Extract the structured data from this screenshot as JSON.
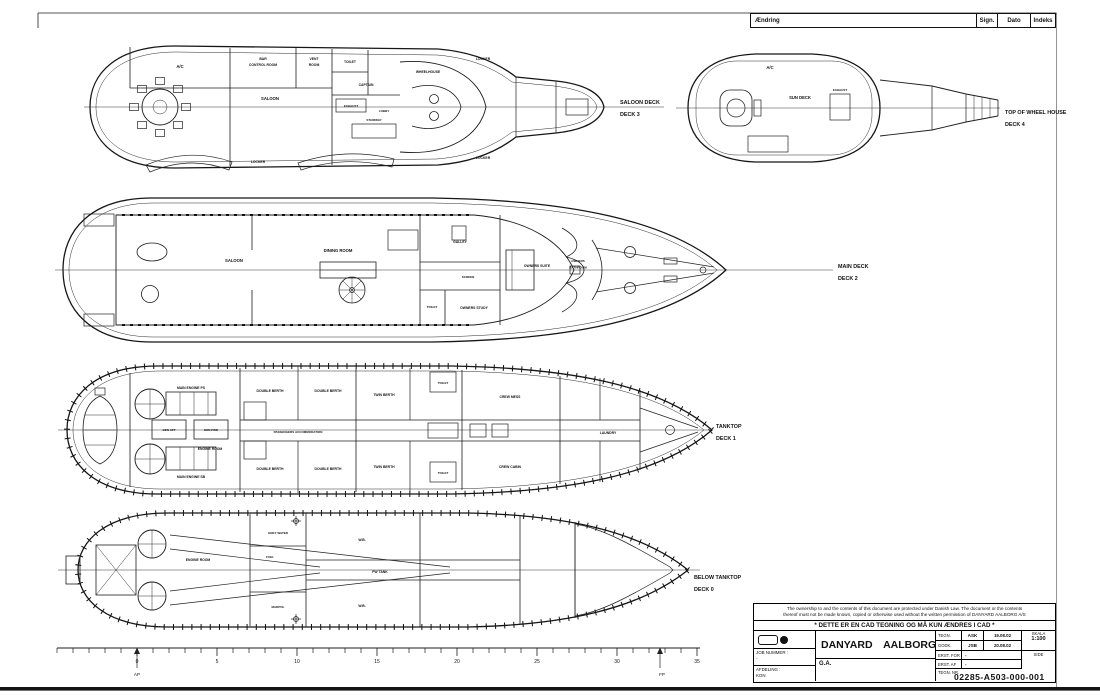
{
  "revision_bar": {
    "change_label": "Ændring",
    "sign_label": "Sign.",
    "date_label": "Dato",
    "index_label": "Indeks"
  },
  "decks": {
    "deck3": {
      "name1": "SALOON DECK",
      "name2": "DECK 3",
      "rooms": {
        "ac": "A/C",
        "bar1": "BAR",
        "bar2": "CONTROL ROOM",
        "vent1": "VENT",
        "vent2": "ROOM",
        "saloon": "SALOON",
        "toilet": "TOILET",
        "captain": "CAPTAIN",
        "exhaust": "EXHAUST",
        "lobby": "LOBBY",
        "stairway": "STAIRWAY",
        "wheelhouse": "WHEELHOUSE",
        "locker": "LOCKER"
      }
    },
    "deck4": {
      "name1": "TOP OF WHEEL HOUSE",
      "name2": "DECK 4",
      "rooms": {
        "sun_deck": "SUN DECK",
        "ac": "A/C",
        "exhaust": "EXHAUST"
      }
    },
    "deck2": {
      "name1": "MAIN DECK",
      "name2": "DECK 2",
      "rooms": {
        "saloon": "SALOON",
        "dining": "DINING ROOM",
        "galley": "GALLEY",
        "screen": "SCREEN",
        "owners_suite": "OWNERS SUITE",
        "owners_bath1": "OWNERS",
        "owners_bath2": "BATHROOM",
        "owners_study": "OWNERS STUDY",
        "toilet": "TOILET"
      }
    },
    "deck1": {
      "name1": "TANKTOP",
      "name2": "DECK 1",
      "rooms": {
        "me_ps": "MAIN ENGINE PS",
        "me_sb": "MAIN ENGINE SB",
        "gen_aft": "GEN AFT",
        "gen_fwd": "GEN FWD",
        "engine_room": "ENGINE ROOM",
        "double_berth": "DOUBLE BERTH",
        "twin_berth": "TWIN BERTH",
        "toilet": "TOILET",
        "corridor": "PASSENGERS ACCOMMODATION",
        "crew_mess": "CREW MESS",
        "crew_cabin": "CREW CABIN",
        "laundry": "LAUNDRY"
      }
    },
    "deck0": {
      "name1": "BELOW TANKTOP",
      "name2": "DECK 0",
      "rooms": {
        "engine_room": "ENGINE ROOM",
        "grey_water": "GREY WATER",
        "fuel": "FUEL",
        "marpol": "MARPOL",
        "wb": "W.B.",
        "fw_tank": "FW TANK"
      }
    }
  },
  "ruler": {
    "n0": "0",
    "n5": "5",
    "n10": "10",
    "n15": "15",
    "n20": "20",
    "n25": "25",
    "n30": "30",
    "n35": "35",
    "ap": "AP",
    "fp": "FP"
  },
  "title_block": {
    "copyright1": "The ownership to and the contents of this document are protected under Danish Law. The document or the contents",
    "copyright2": "thereof must not be made known, copied or otherwise used without the written permission of DANYARD AALBORG A/S",
    "cad_note": "* DETTE ER EN CAD TEGNING OG MÅ KUN ÆNDRES I CAD *",
    "company": "DANYARD AALBORG",
    "job_number_label": "JOB NUMMER :",
    "job_number_value": "-",
    "department_label": "AFDELING :",
    "department_value": "KON",
    "ga_value": "G.A.",
    "tegn_label": "TEGN.",
    "tegn_value": "ASK",
    "tegn_date": "19.08.02",
    "godk_label": "GODK.",
    "godk_value": "JSB",
    "godk_date": "20.08.02",
    "erst_for_label": "ERST. FOR",
    "erst_for_value": "-",
    "erst_af_label": "ERST. AF",
    "erst_af_value": "-",
    "skala_label": "SKALA",
    "skala_value": "1:100",
    "side_label": "SIDE",
    "tegn_nr_label": "TEGN. NR.",
    "tegn_nr_value": "02285-A503-000-001"
  }
}
